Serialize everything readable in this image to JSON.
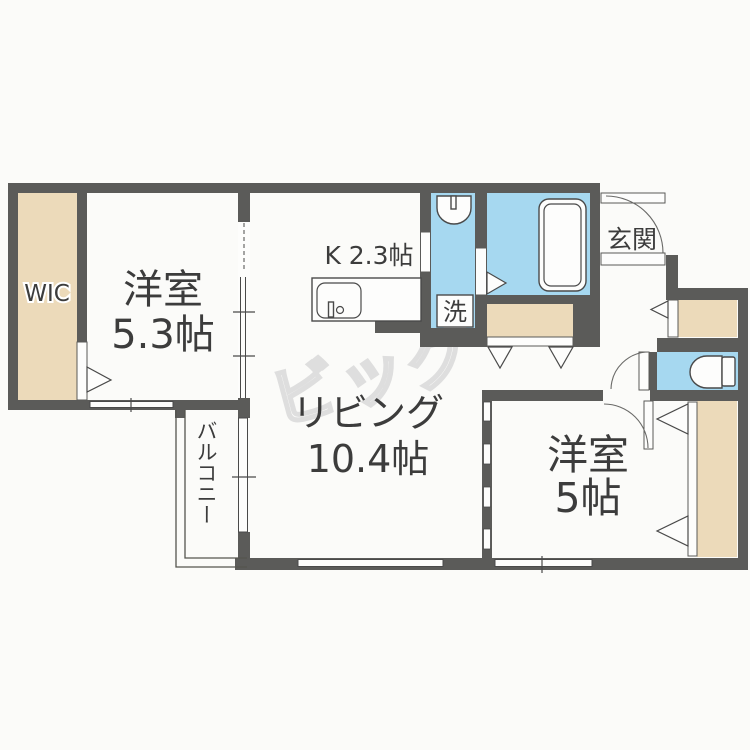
{
  "floorplan": {
    "watermark": "ビッグ",
    "labels": {
      "wic": "WIC",
      "bedroom1": {
        "name": "洋室",
        "size": "5.3帖"
      },
      "kitchen": "K 2.3帖",
      "living": {
        "name": "リビング",
        "size": "10.4帖"
      },
      "bedroom2": {
        "name": "洋室",
        "size": "5帖"
      },
      "entrance": "玄関",
      "laundry": "洗",
      "balcony": "バルコニー"
    },
    "colors": {
      "wall": "#5b5b59",
      "closet_beige": "#ecdaba",
      "water_blue": "#a6d8f0",
      "background": "#fbfbf9",
      "text": "#3c3c3c",
      "watermark": "#dedede"
    }
  }
}
